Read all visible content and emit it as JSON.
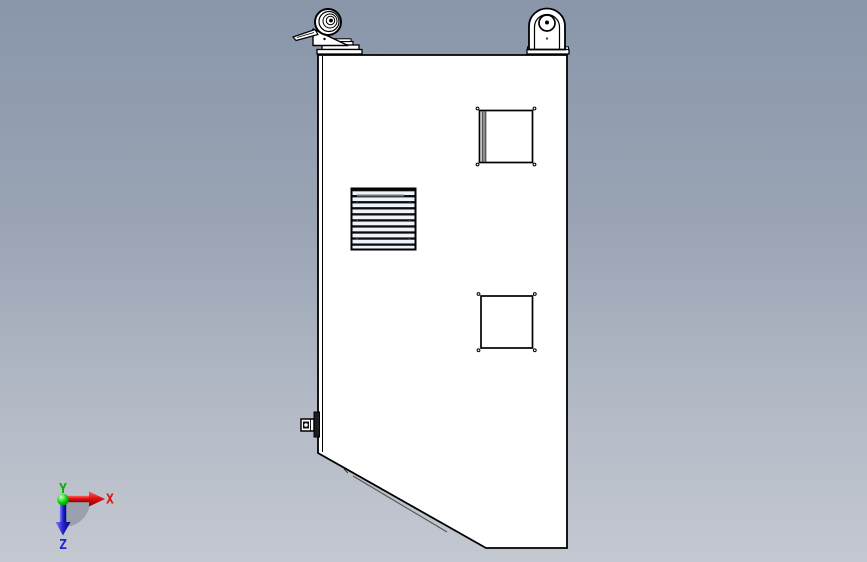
{
  "viewport": {
    "type": "3d-cad-viewport",
    "background_top_color": "#8996aa",
    "background_bottom_color": "#c4c8d0",
    "model_fill_color": "#ffffff",
    "model_outline_color": "#000000",
    "grille_slat_color": "#edf2fb"
  },
  "axis_triad": {
    "x_label": "X",
    "y_label": "Y",
    "z_label": "Z",
    "x_color": "#e01010",
    "y_color": "#00b400",
    "z_color": "#2424cf",
    "origin_ball_color": "#00cc00",
    "shadow_color": "#6e7684"
  },
  "model": {
    "parts": {
      "left_caster": "swivel-caster-with-brake-lever",
      "right_caster": "swivel-caster-front-view",
      "vent": "louvered-vent-grille",
      "upper_panel": "square-cutout-with-corner-screws",
      "lower_panel": "square-cutout-with-corner-screws",
      "side_bracket": "side-latch-bracket",
      "body": "enclosure-cabinet-side-panel"
    }
  }
}
